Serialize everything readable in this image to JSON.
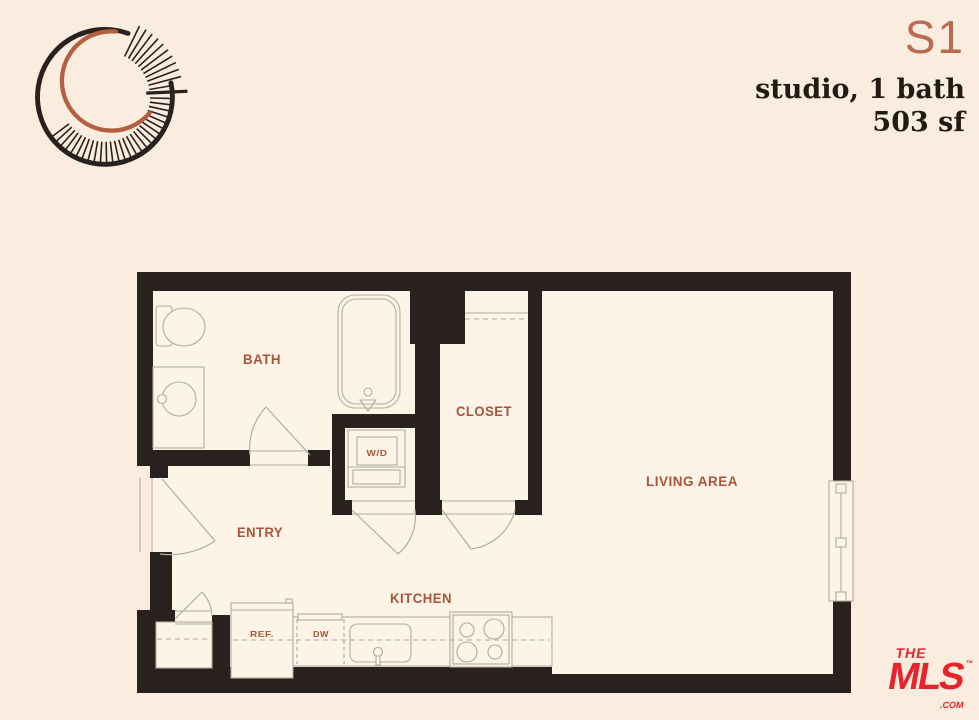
{
  "page": {
    "background": "#faeddf",
    "floor": "#fdf3e7"
  },
  "logo": {
    "ring_color": "#29211d",
    "crescent_color": "#b2603f"
  },
  "header": {
    "plan_code": "S1",
    "subtitle_line1": "studio, 1 bath",
    "subtitle_line2": "503 sf",
    "accent_color": "#b96b51",
    "text_color": "#221b15"
  },
  "floorplan": {
    "wall_color": "#29211d",
    "line_color": "#b5aa9d",
    "label_color": "#a9533b",
    "rooms": {
      "bath": "BATH",
      "closet": "CLOSET",
      "entry": "ENTRY",
      "kitchen": "KITCHEN",
      "living_area": "LIVING AREA"
    },
    "fixtures": {
      "washer_dryer": "W/D",
      "refrigerator": "REF.",
      "dishwasher": "DW"
    }
  },
  "footer_logo": {
    "the": "THE",
    "name": "MLS",
    "trademark": "™",
    "domain": ".COM",
    "color": "#e7242c"
  }
}
